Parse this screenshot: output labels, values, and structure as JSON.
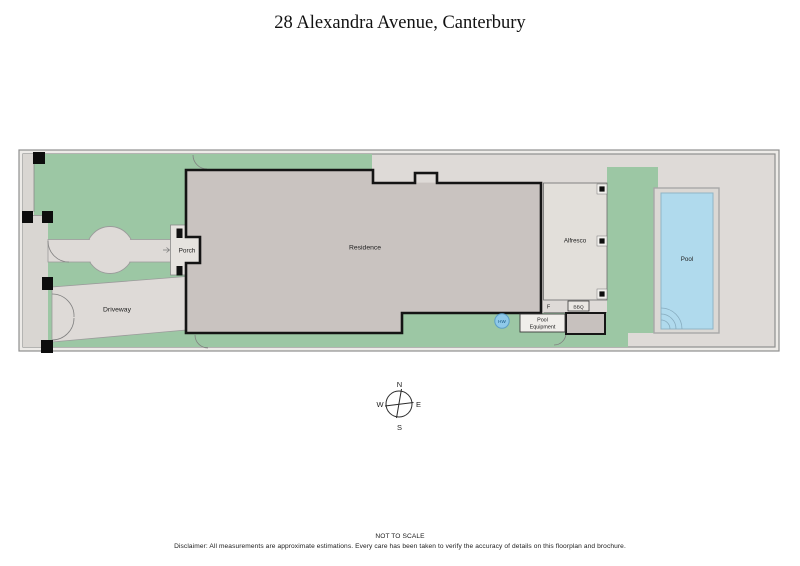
{
  "title": "28 Alexandra Avenue, Canterbury",
  "labels": {
    "residence": "Residence",
    "porch": "Porch",
    "driveway": "Driveway",
    "alfresco": "Alfresco",
    "pool": "Pool",
    "pool_equipment_line1": "Pool",
    "pool_equipment_line2": "Equipment",
    "bbq": "BBQ",
    "f": "F",
    "hw": "HW"
  },
  "compass": {
    "n": "N",
    "e": "E",
    "s": "S",
    "w": "W"
  },
  "footer": {
    "scale_note": "NOT TO SCALE",
    "disclaimer": "Disclaimer: All measurements are approximate estimations. Every care has been taken to verify the accuracy of details on this floorplan and brochure."
  },
  "colors": {
    "grass": "#9cc7a4",
    "paving": "#dedad7",
    "residence_fill": "#c9c3c0",
    "pool_water": "#b0daed",
    "hot_water": "#8fc9e9"
  }
}
